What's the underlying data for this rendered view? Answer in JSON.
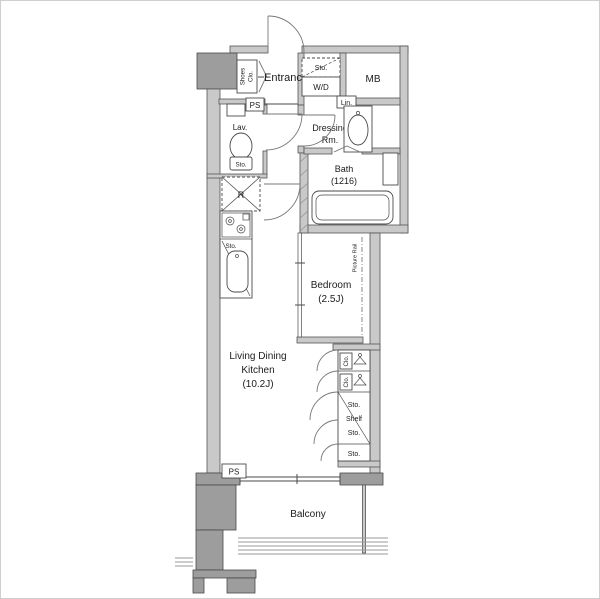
{
  "title": "Apartment floor plan",
  "colors": {
    "background": "#ffffff",
    "wall_light": "#c9c9c9",
    "wall_dark": "#9d9d9d",
    "line": "#4a4a4a"
  },
  "rooms": {
    "entrance": {
      "label": "Entrance"
    },
    "shoes_closet": {
      "line1": "Shoes",
      "line2": "Clo."
    },
    "lavatory": {
      "label": "Lav.",
      "toilet_storage": "Sto."
    },
    "dressing_room": {
      "line1": "Dressing",
      "line2": "Rm."
    },
    "bath": {
      "line1": "Bath",
      "line2": "(1216)"
    },
    "bedroom": {
      "line1": "Bedroom",
      "line2": "(2.5J)",
      "picture_rail": "Picture Rail"
    },
    "ldk": {
      "line1": "Living Dining",
      "line2": "Kitchen",
      "line3": "(10.2J)"
    },
    "balcony": {
      "label": "Balcony"
    }
  },
  "fixtures": {
    "meter_box": "MB",
    "linen": "Lin.",
    "storage_above_washer": "Sto.",
    "washer_dryer": "W/D",
    "refrigerator": "R",
    "kitchen_storage": "Sto.",
    "pipe_space_upper": "PS",
    "pipe_space_lower": "PS",
    "closet_upper": "Clo.",
    "closet_lower": "Clo.",
    "storage_column_top": "Sto.",
    "storage_column_shelf": "Shelf",
    "storage_column_mid": "Sto.",
    "storage_column_bottom": "Sto."
  }
}
